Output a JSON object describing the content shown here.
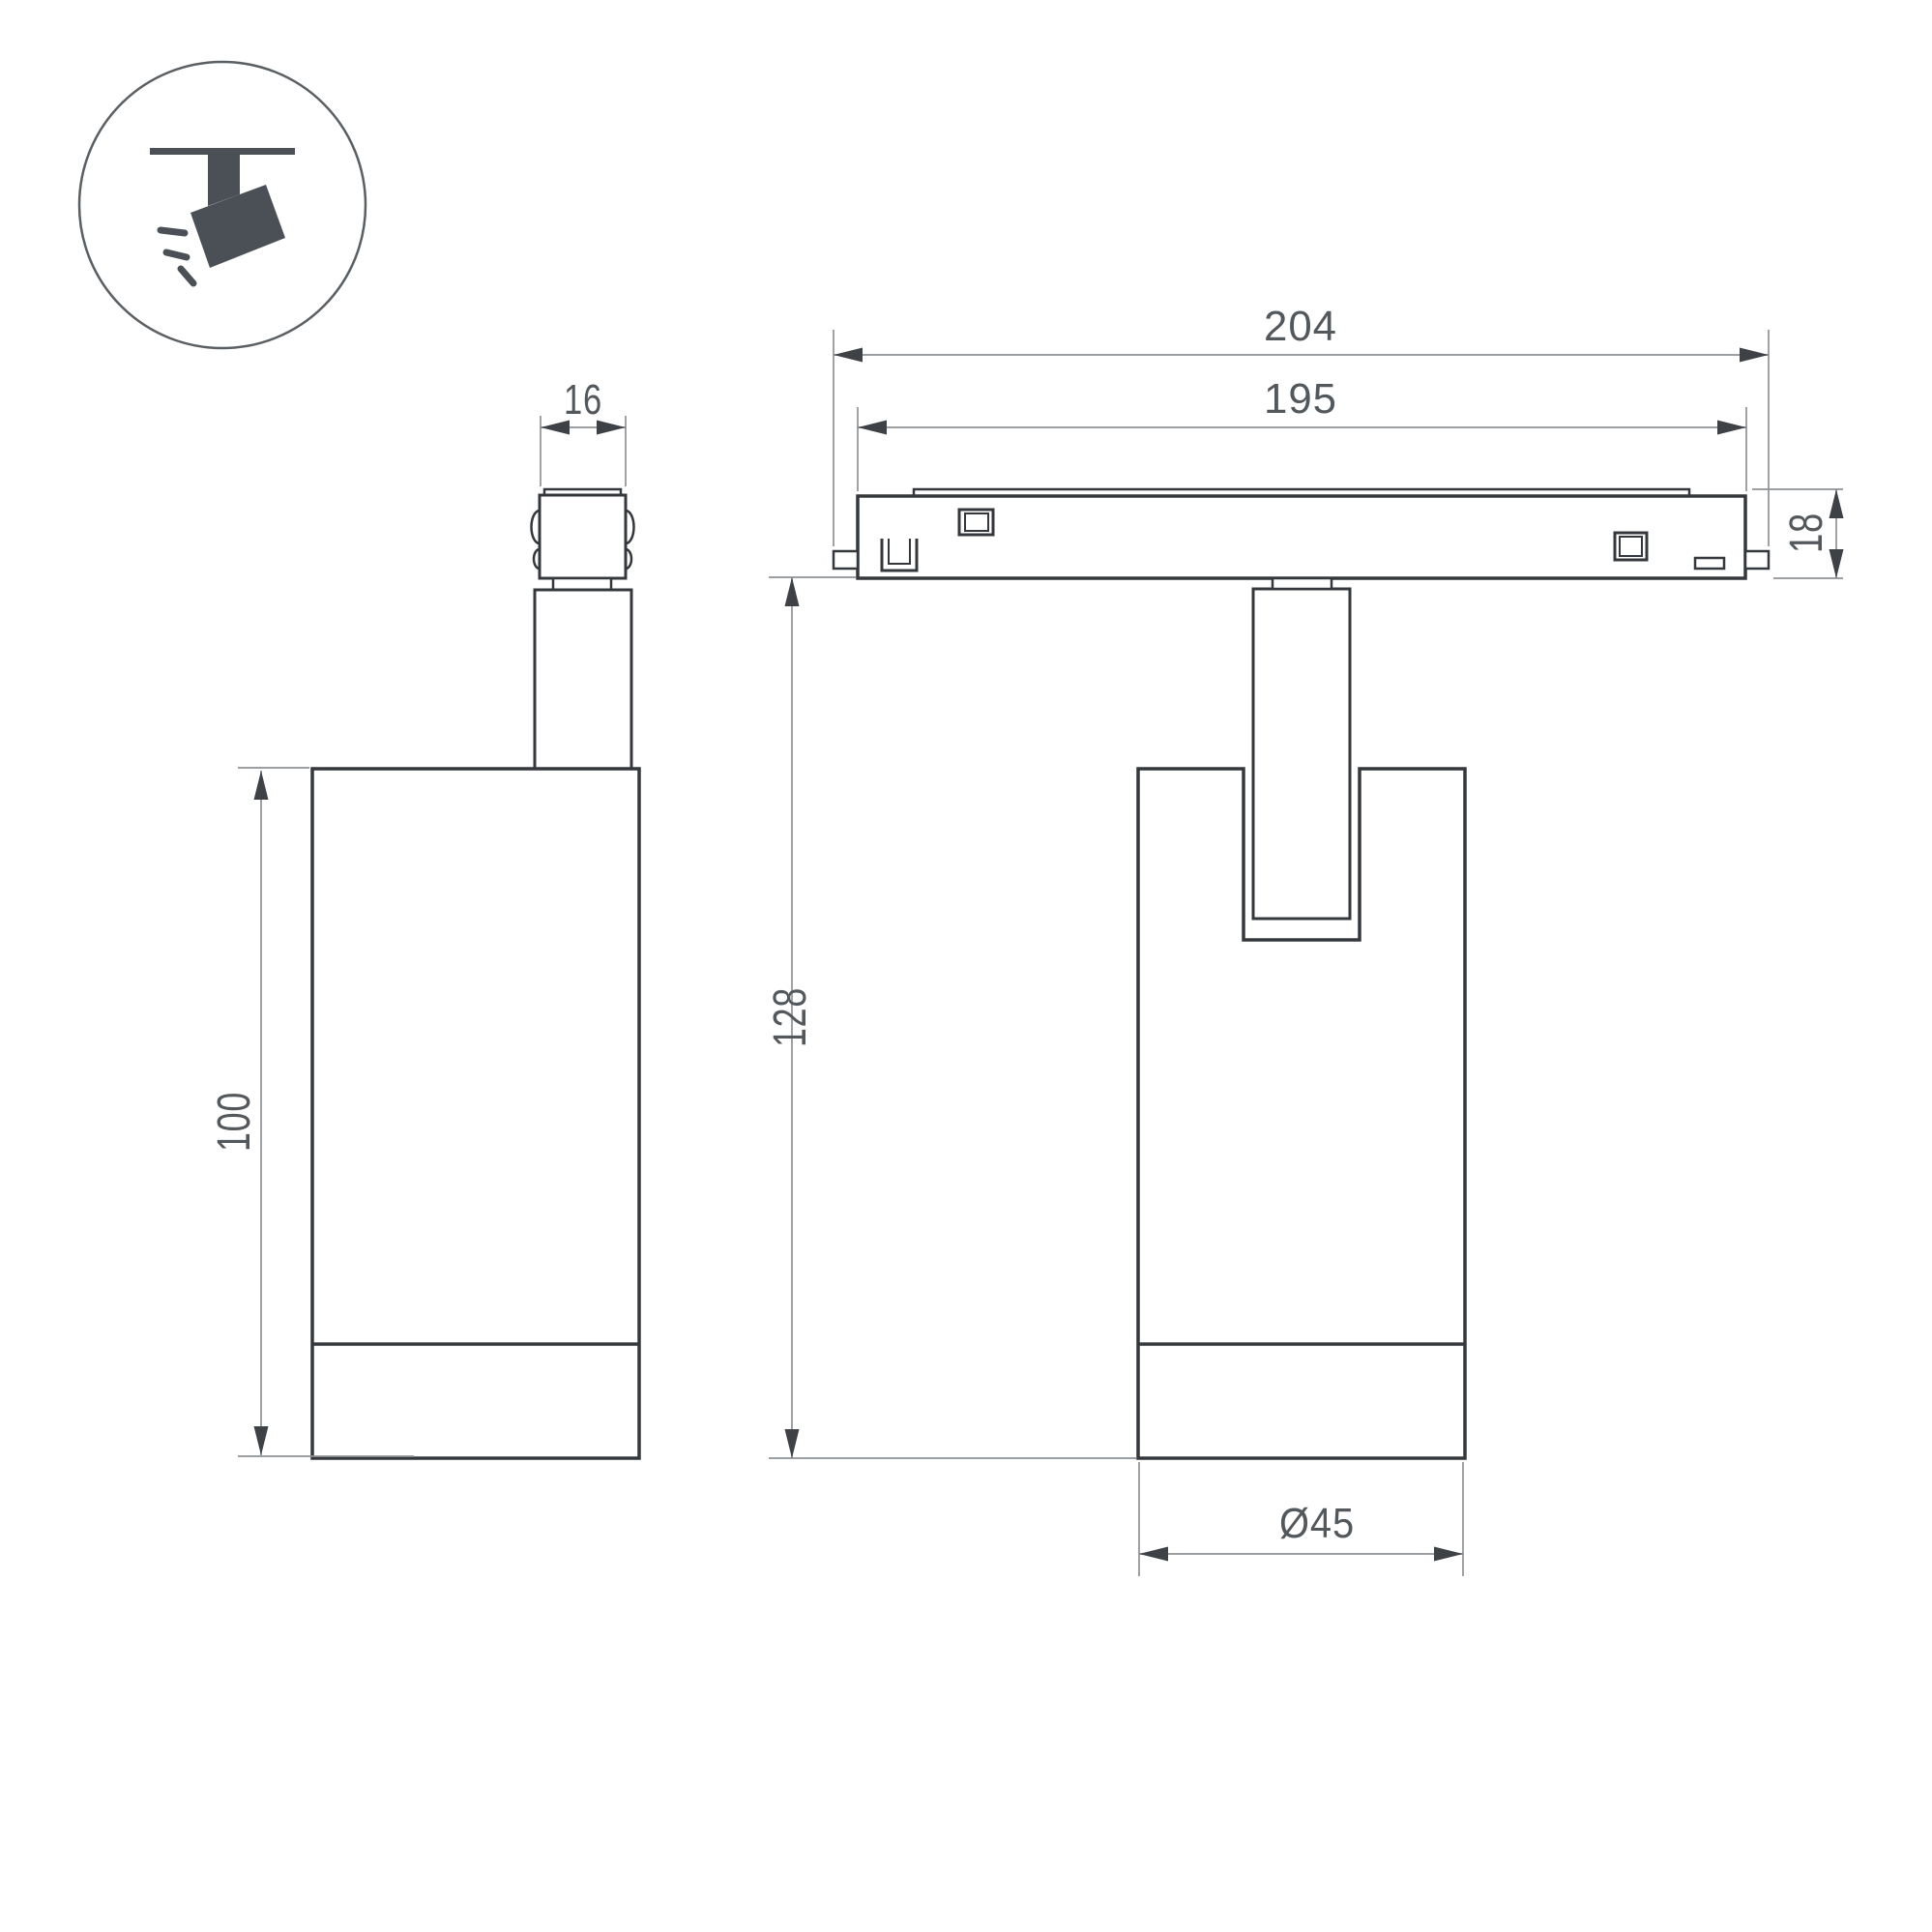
{
  "title": "track-spotlight-technical-drawing",
  "icon": {
    "label": "ceiling-track-spotlight-pictogram"
  },
  "dims": {
    "d16": "16",
    "d204": "204",
    "d195": "195",
    "d18": "18",
    "d128": "128",
    "d100": "100",
    "d45": "Ø45"
  },
  "colors": {
    "outline": "#34383c",
    "dimension_lines": "#8f9296",
    "dimension_text": "#53585c",
    "icon": "#4a5055",
    "background": "#ffffff"
  }
}
